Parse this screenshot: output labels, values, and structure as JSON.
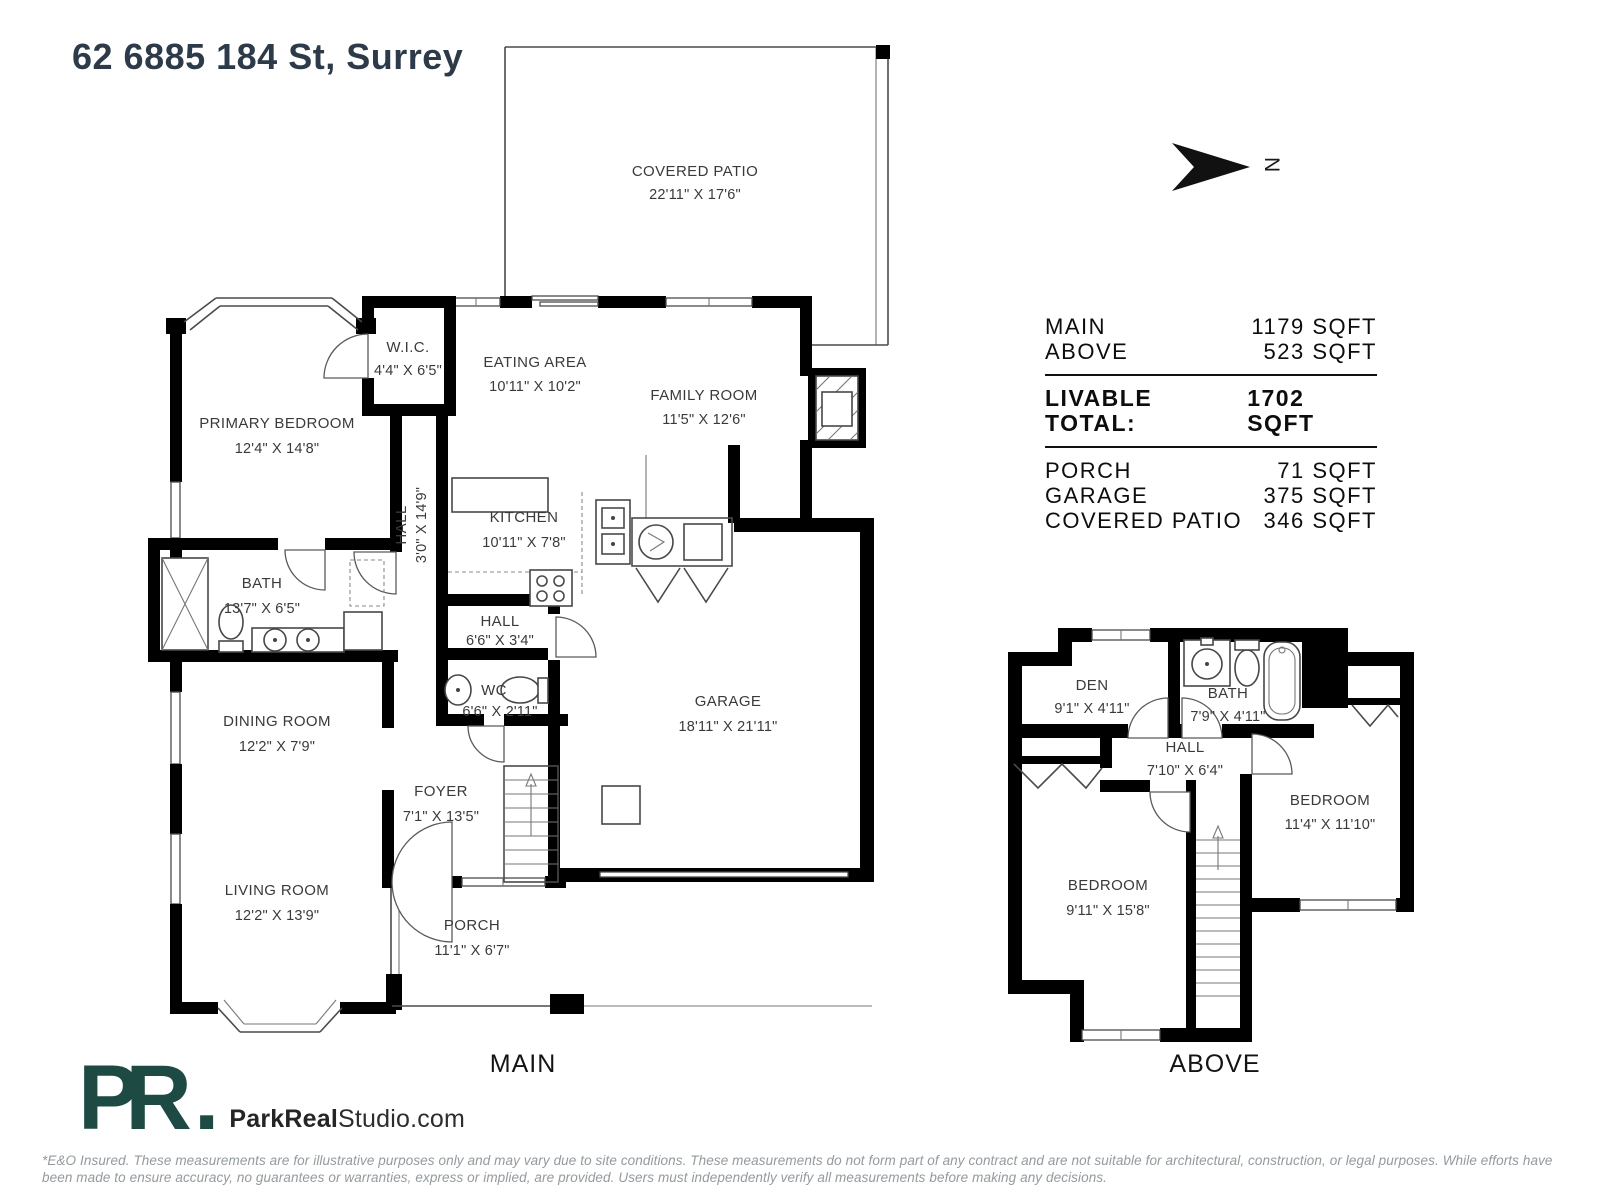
{
  "title": "62 6885 184 St, Surrey",
  "compass": {
    "label": "N"
  },
  "summary": {
    "main": {
      "label": "MAIN",
      "value": "1179 SQFT"
    },
    "above": {
      "label": "ABOVE",
      "value": "523 SQFT"
    },
    "total": {
      "label": "LIVABLE TOTAL:",
      "value": "1702 SQFT"
    },
    "porch": {
      "label": "PORCH",
      "value": "71 SQFT"
    },
    "garage": {
      "label": "GARAGE",
      "value": "375 SQFT"
    },
    "covered_patio": {
      "label": "COVERED PATIO",
      "value": "346 SQFT"
    }
  },
  "main_floor": {
    "caption": "MAIN",
    "rooms": {
      "covered_patio": {
        "name": "COVERED PATIO",
        "dims": "22'11\" X 17'6\""
      },
      "wic": {
        "name": "W.I.C.",
        "dims": "4'4\" X 6'5\""
      },
      "eating_area": {
        "name": "EATING AREA",
        "dims": "10'11\" X 10'2\""
      },
      "family_room": {
        "name": "FAMILY ROOM",
        "dims": "11'5\" X 12'6\""
      },
      "primary_bedroom": {
        "name": "PRIMARY BEDROOM",
        "dims": "12'4\" X 14'8\""
      },
      "hall": {
        "name": "HALL",
        "dims": "3'0\" X 14'9\""
      },
      "kitchen": {
        "name": "KITCHEN",
        "dims": "10'11\" X 7'8\""
      },
      "bath": {
        "name": "BATH",
        "dims": "13'7\" X 6'5\""
      },
      "hall_small": {
        "name": "HALL",
        "dims": "6'6\" X 3'4\""
      },
      "wc": {
        "name": "WC",
        "dims": "6'6\" X 2'11\""
      },
      "dining_room": {
        "name": "DINING ROOM",
        "dims": "12'2\" X 7'9\""
      },
      "garage": {
        "name": "GARAGE",
        "dims": "18'11\" X 21'11\""
      },
      "foyer": {
        "name": "FOYER",
        "dims": "7'1\" X 13'5\""
      },
      "living_room": {
        "name": "LIVING ROOM",
        "dims": "12'2\" X 13'9\""
      },
      "porch": {
        "name": "PORCH",
        "dims": "11'1\" X 6'7\""
      }
    }
  },
  "above_floor": {
    "caption": "ABOVE",
    "rooms": {
      "den": {
        "name": "DEN",
        "dims": "9'1\" X 4'11\""
      },
      "bath": {
        "name": "BATH",
        "dims": "7'9\" X 4'11\""
      },
      "hall": {
        "name": "HALL",
        "dims": "7'10\" X 6'4\""
      },
      "bedroom_right": {
        "name": "BEDROOM",
        "dims": "11'4\" X 11'10\""
      },
      "bedroom_left": {
        "name": "BEDROOM",
        "dims": "9'11\" X 15'8\""
      }
    }
  },
  "branding": {
    "monogram": "PR",
    "monogram_dot": ".",
    "brand_bold": "ParkReal",
    "brand_light": "Studio.com"
  },
  "colors": {
    "brand": "#1d4a43",
    "title": "#2d3a49",
    "wall": "#000000"
  },
  "disclaimer": "*E&O Insured. These measurements are for illustrative purposes only and may vary due to site conditions. These measurements do not form part of any contract and are not suitable for architectural, construction, or legal purposes. While efforts have been made to ensure accuracy, no guarantees or warranties, express or implied, are provided. Users must independently verify all measurements before making any decisions."
}
